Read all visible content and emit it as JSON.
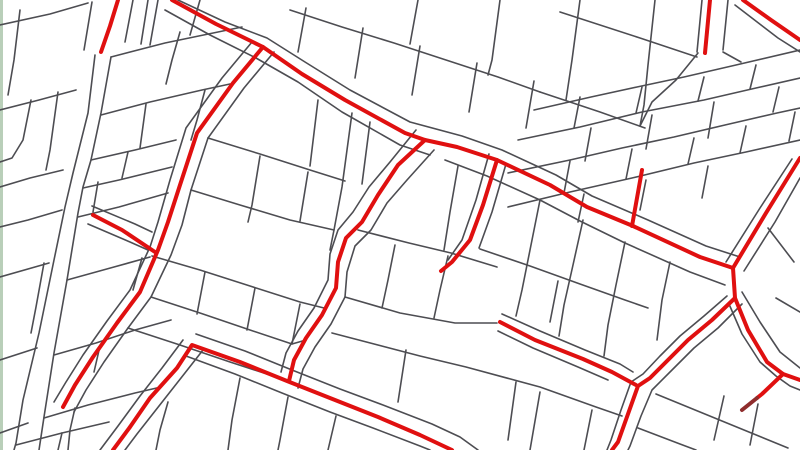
{
  "map": {
    "viewport": {
      "width": 800,
      "height": 450
    },
    "background_color": "#ffffff",
    "parcel_style": {
      "color": "#4d4d52",
      "width": 1.6
    },
    "road_style": {
      "color": "#e01010",
      "width": 4
    },
    "road_accent_style": {
      "color": "#8f2d2d",
      "width": 4
    },
    "sheet_edge": {
      "color": "#b9cfb9",
      "x": 1.5,
      "width": 3
    },
    "road_lines": [
      [
        118,
        0,
        110,
        26,
        101,
        52
      ],
      [
        172,
        0,
        216,
        24,
        263,
        47,
        302,
        74,
        345,
        100,
        405,
        133,
        425,
        140,
        457,
        147,
        497,
        160,
        550,
        185,
        587,
        207,
        633,
        226,
        700,
        257,
        733,
        268
      ],
      [
        263,
        47,
        233,
        83,
        197,
        133,
        180,
        185,
        168,
        222,
        158,
        250,
        140,
        292,
        117,
        323,
        93,
        357,
        75,
        385,
        63,
        407
      ],
      [
        93,
        215,
        122,
        230,
        155,
        252
      ],
      [
        710,
        0,
        705,
        53
      ],
      [
        743,
        0,
        771,
        20,
        800,
        40
      ],
      [
        425,
        140,
        398,
        165,
        378,
        195,
        362,
        222,
        346,
        238,
        338,
        262,
        336,
        288,
        322,
        315,
        306,
        338,
        294,
        360,
        289,
        381
      ],
      [
        497,
        160,
        483,
        205,
        470,
        240,
        452,
        262,
        441,
        271
      ],
      [
        632,
        226,
        642,
        170
      ],
      [
        113,
        450,
        130,
        427,
        150,
        398,
        177,
        368,
        192,
        345,
        240,
        362,
        287,
        381,
        335,
        400,
        378,
        417,
        420,
        435,
        452,
        450
      ],
      [
        500,
        322,
        535,
        340,
        583,
        359,
        612,
        372,
        636,
        385
      ],
      [
        733,
        268,
        735,
        298,
        712,
        320,
        688,
        340,
        668,
        360,
        650,
        378,
        638,
        386,
        628,
        414,
        618,
        442,
        612,
        450
      ],
      [
        735,
        298,
        748,
        330,
        767,
        362,
        783,
        374,
        800,
        380
      ],
      [
        783,
        374,
        762,
        394,
        757,
        398
      ],
      [
        733,
        268,
        766,
        213,
        800,
        158
      ]
    ],
    "road_accent_lines": [
      [
        757,
        398,
        742,
        410
      ]
    ],
    "parcel_lines": [
      [
        95,
        55,
        88,
        113,
        73,
        173,
        65,
        207,
        54,
        260,
        39,
        333,
        23,
        400,
        16,
        443,
        14,
        450
      ],
      [
        111,
        57,
        101,
        113,
        91,
        160,
        83,
        187,
        78,
        213,
        67,
        280,
        54,
        353,
        44,
        417,
        39,
        450
      ],
      [
        0,
        25,
        50,
        14,
        88,
        3
      ],
      [
        0,
        110,
        39,
        100,
        76,
        90
      ],
      [
        0,
        187,
        30,
        178,
        63,
        170
      ],
      [
        0,
        227,
        28,
        220,
        62,
        210
      ],
      [
        0,
        277,
        49,
        263
      ],
      [
        0,
        360,
        37,
        348
      ],
      [
        0,
        433,
        28,
        423
      ],
      [
        31,
        100,
        23,
        140,
        12,
        158,
        0,
        162
      ],
      [
        44,
        263,
        36,
        307,
        31,
        333
      ],
      [
        20,
        10,
        14,
        60,
        8,
        95
      ],
      [
        58,
        92,
        50,
        150,
        46,
        170
      ],
      [
        62,
        433,
        58,
        450
      ],
      [
        111,
        57,
        165,
        43,
        218,
        32,
        242,
        27
      ],
      [
        101,
        115,
        150,
        102,
        202,
        90,
        230,
        84
      ],
      [
        91,
        160,
        135,
        150,
        176,
        140
      ],
      [
        83,
        188,
        119,
        180,
        172,
        167
      ],
      [
        78,
        217,
        119,
        207,
        168,
        193
      ],
      [
        67,
        280,
        114,
        267,
        150,
        257
      ],
      [
        54,
        355,
        96,
        343,
        135,
        330,
        171,
        320
      ],
      [
        44,
        418,
        88,
        405,
        135,
        393,
        161,
        387
      ],
      [
        16,
        445,
        62,
        433,
        109,
        422
      ],
      [
        146,
        104,
        140,
        148
      ],
      [
        128,
        152,
        122,
        178
      ],
      [
        98,
        182,
        93,
        212
      ],
      [
        142,
        258,
        133,
        290
      ],
      [
        100,
        346,
        94,
        372
      ],
      [
        75,
        408,
        70,
        430,
        68,
        450
      ],
      [
        180,
        32,
        172,
        60,
        166,
        84
      ],
      [
        205,
        90,
        197,
        120,
        191,
        140
      ],
      [
        92,
        206,
        135,
        224,
        152,
        232
      ],
      [
        88,
        224,
        130,
        242,
        148,
        250
      ],
      [
        252,
        42,
        222,
        78,
        186,
        128,
        170,
        180,
        158,
        222,
        150,
        247,
        130,
        290,
        107,
        321,
        83,
        355,
        66,
        382,
        54,
        402
      ],
      [
        274,
        52,
        244,
        88,
        208,
        138,
        191,
        190,
        182,
        225,
        171,
        255,
        151,
        297,
        128,
        328,
        104,
        362,
        86,
        390,
        74,
        412
      ],
      [
        92,
        2,
        84,
        50
      ],
      [
        133,
        0,
        125,
        42
      ],
      [
        158,
        0,
        150,
        45
      ],
      [
        200,
        0,
        190,
        35
      ],
      [
        178,
        0,
        225,
        22,
        267,
        38,
        305,
        62,
        350,
        90,
        410,
        122,
        462,
        136,
        502,
        150,
        556,
        175,
        592,
        196,
        648,
        220,
        706,
        246,
        740,
        257
      ],
      [
        165,
        10,
        210,
        35,
        256,
        58,
        298,
        82,
        342,
        112,
        400,
        145,
        430,
        155
      ],
      [
        445,
        160,
        487,
        176,
        540,
        200,
        580,
        221,
        625,
        243,
        690,
        272,
        725,
        285
      ],
      [
        290,
        10,
        342,
        27,
        394,
        43,
        446,
        60,
        498,
        77,
        540,
        92
      ],
      [
        306,
        8,
        298,
        52
      ],
      [
        363,
        28,
        355,
        78
      ],
      [
        420,
        46,
        412,
        95
      ],
      [
        477,
        63,
        469,
        112
      ],
      [
        534,
        81,
        526,
        128
      ],
      [
        540,
        92,
        600,
        112,
        645,
        128
      ],
      [
        418,
        0,
        410,
        44
      ],
      [
        500,
        0,
        492,
        60,
        488,
        75
      ],
      [
        580,
        0,
        572,
        60,
        566,
        100
      ],
      [
        655,
        0,
        648,
        65,
        644,
        105,
        640,
        126
      ],
      [
        560,
        12,
        640,
        38,
        697,
        57
      ],
      [
        702,
        0,
        697,
        52
      ],
      [
        728,
        0,
        723,
        50
      ],
      [
        698,
        53,
        676,
        80,
        652,
        102,
        640,
        126
      ],
      [
        723,
        52,
        741,
        62
      ],
      [
        735,
        5,
        778,
        38,
        800,
        52
      ],
      [
        534,
        110,
        591,
        97,
        637,
        87,
        684,
        77,
        736,
        65,
        800,
        50
      ],
      [
        518,
        140,
        580,
        127,
        642,
        112,
        704,
        100,
        756,
        88,
        800,
        78
      ],
      [
        508,
        173,
        570,
        160,
        622,
        148,
        674,
        137,
        725,
        125,
        777,
        113,
        800,
        108
      ],
      [
        580,
        97,
        574,
        128
      ],
      [
        642,
        87,
        636,
        113
      ],
      [
        704,
        77,
        698,
        101
      ],
      [
        756,
        65,
        750,
        89
      ],
      [
        591,
        128,
        585,
        161
      ],
      [
        652,
        115,
        646,
        149
      ],
      [
        714,
        102,
        708,
        138
      ],
      [
        779,
        87,
        773,
        112
      ],
      [
        508,
        207,
        570,
        192,
        632,
        178,
        694,
        163,
        746,
        152,
        800,
        140
      ],
      [
        570,
        161,
        564,
        193
      ],
      [
        632,
        149,
        626,
        179
      ],
      [
        694,
        138,
        688,
        164
      ],
      [
        746,
        126,
        740,
        153
      ],
      [
        795,
        112,
        789,
        141
      ],
      [
        726,
        262,
        760,
        208,
        792,
        159
      ],
      [
        744,
        271,
        775,
        222,
        800,
        178
      ],
      [
        584,
        194,
        578,
        222
      ],
      [
        646,
        180,
        640,
        210
      ],
      [
        708,
        166,
        702,
        198
      ],
      [
        358,
        230,
        409,
        243,
        451,
        253,
        497,
        267
      ],
      [
        352,
        113,
        342,
        187,
        334,
        230,
        330,
        250
      ],
      [
        458,
        166,
        450,
        212,
        444,
        250
      ],
      [
        489,
        154,
        476,
        200,
        462,
        240,
        448,
        260
      ],
      [
        506,
        164,
        492,
        212,
        479,
        248
      ],
      [
        345,
        297,
        400,
        313,
        455,
        323,
        497,
        323
      ],
      [
        502,
        314,
        540,
        331,
        585,
        350,
        620,
        364,
        633,
        372
      ],
      [
        498,
        331,
        533,
        348,
        578,
        367,
        608,
        380
      ],
      [
        332,
        333,
        420,
        356,
        466,
        367,
        540,
        387,
        596,
        407,
        622,
        416
      ],
      [
        183,
        340,
        162,
        368,
        140,
        396,
        118,
        426,
        103,
        446,
        100,
        450
      ],
      [
        203,
        350,
        181,
        378,
        159,
        406,
        137,
        434,
        125,
        450
      ],
      [
        196,
        334,
        245,
        351,
        292,
        370,
        340,
        389,
        383,
        405,
        432,
        424,
        460,
        437,
        478,
        450
      ],
      [
        186,
        356,
        235,
        374,
        282,
        393,
        330,
        412,
        373,
        428,
        420,
        446,
        430,
        450
      ],
      [
        406,
        350,
        398,
        402
      ],
      [
        516,
        382,
        508,
        440
      ],
      [
        168,
        402,
        160,
        430,
        156,
        450
      ],
      [
        240,
        378,
        232,
        420,
        228,
        450
      ],
      [
        288,
        397,
        280,
        440,
        278,
        450
      ],
      [
        336,
        416,
        328,
        450
      ],
      [
        540,
        200,
        530,
        250,
        522,
        290,
        516,
        316
      ],
      [
        583,
        220,
        573,
        265,
        564,
        305,
        559,
        336
      ],
      [
        625,
        242,
        616,
        285,
        608,
        325,
        604,
        356
      ],
      [
        670,
        262,
        662,
        300,
        657,
        340
      ],
      [
        742,
        292,
        760,
        322,
        780,
        352,
        800,
        368
      ],
      [
        729,
        304,
        742,
        334,
        760,
        362,
        776,
        376,
        790,
        386,
        800,
        390
      ],
      [
        727,
        296,
        704,
        316,
        680,
        336,
        660,
        356,
        643,
        374,
        631,
        382,
        621,
        410,
        611,
        440,
        607,
        450
      ],
      [
        742,
        304,
        718,
        328,
        694,
        348,
        674,
        368,
        652,
        390,
        641,
        416,
        630,
        446,
        628,
        450
      ],
      [
        656,
        394,
        700,
        412,
        744,
        430,
        788,
        448
      ],
      [
        638,
        428,
        680,
        444,
        696,
        450
      ],
      [
        724,
        396,
        714,
        440
      ],
      [
        758,
        404,
        750,
        445
      ],
      [
        768,
        228,
        794,
        262
      ],
      [
        776,
        298,
        800,
        312
      ],
      [
        540,
        392,
        530,
        450
      ],
      [
        592,
        410,
        584,
        450
      ],
      [
        152,
        256,
        200,
        270,
        250,
        286,
        300,
        302,
        324,
        308
      ],
      [
        151,
        297,
        200,
        313,
        250,
        330,
        292,
        344,
        306,
        340
      ],
      [
        128,
        328,
        180,
        345,
        230,
        362,
        270,
        375,
        290,
        382
      ],
      [
        205,
        272,
        197,
        314
      ],
      [
        255,
        288,
        247,
        330
      ],
      [
        300,
        304,
        292,
        344
      ],
      [
        395,
        245,
        388,
        280,
        382,
        308
      ],
      [
        448,
        256,
        440,
        290,
        434,
        318
      ],
      [
        208,
        138,
        260,
        154,
        310,
        170,
        345,
        181
      ],
      [
        191,
        190,
        240,
        205,
        290,
        220,
        334,
        230
      ],
      [
        260,
        156,
        252,
        205,
        248,
        222
      ],
      [
        308,
        172,
        300,
        221
      ],
      [
        318,
        100,
        310,
        166
      ],
      [
        370,
        122,
        362,
        184
      ],
      [
        416,
        130,
        390,
        162,
        369,
        187,
        353,
        212,
        338,
        230,
        330,
        254,
        328,
        280,
        314,
        308,
        298,
        331,
        286,
        353,
        281,
        372
      ],
      [
        434,
        150,
        407,
        180,
        387,
        203,
        371,
        230,
        355,
        246,
        347,
        272,
        345,
        297,
        331,
        324,
        315,
        347,
        303,
        369,
        298,
        388
      ],
      [
        148,
        0,
        141,
        44
      ],
      [
        480,
        249,
        530,
        266,
        580,
        284,
        625,
        300,
        648,
        308
      ],
      [
        558,
        281,
        550,
        322
      ]
    ]
  }
}
